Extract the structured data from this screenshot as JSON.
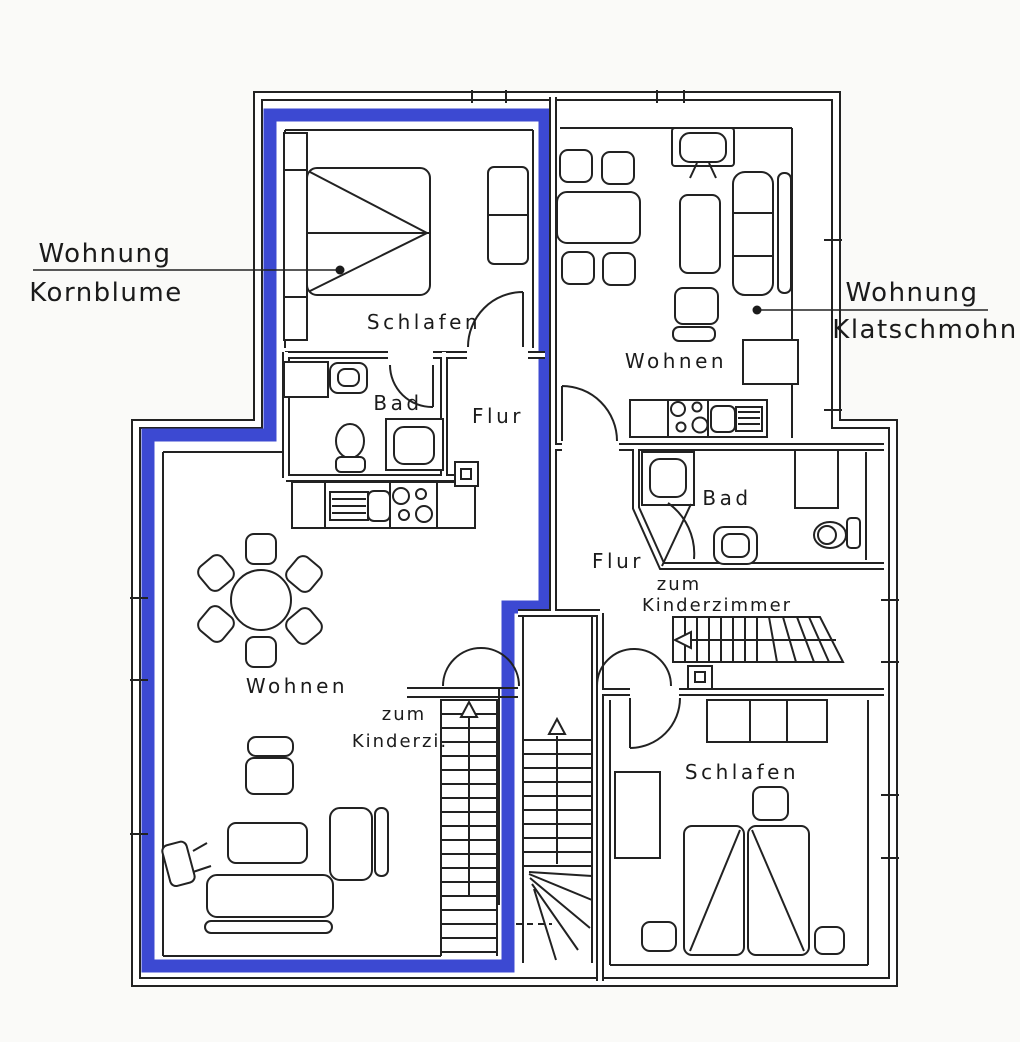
{
  "diagram": {
    "type": "floor-plan",
    "colors": {
      "boundary_highlight": "#3c49d2",
      "line": "#222222",
      "background": "#fafaf8"
    },
    "callouts": {
      "kornblume": {
        "line1": "Wohnung",
        "line2": "Kornblume"
      },
      "klatschmohn": {
        "line1": "Wohnung",
        "line2": "Klatschmohn"
      }
    },
    "rooms": {
      "kornblume_schlafen": "Schlafen",
      "kornblume_bad": "Bad",
      "kornblume_flur": "Flur",
      "kornblume_wohnen": "Wohnen",
      "kornblume_stairs": {
        "line1": "zum",
        "line2": "Kinderzi."
      },
      "klatschmohn_wohnen": "Wohnen",
      "klatschmohn_bad": "Bad",
      "klatschmohn_flur": "Flur",
      "klatschmohn_stairs": {
        "line1": "zum",
        "line2": "Kinderzimmer"
      },
      "klatschmohn_schlafen": "Schlafen"
    }
  }
}
